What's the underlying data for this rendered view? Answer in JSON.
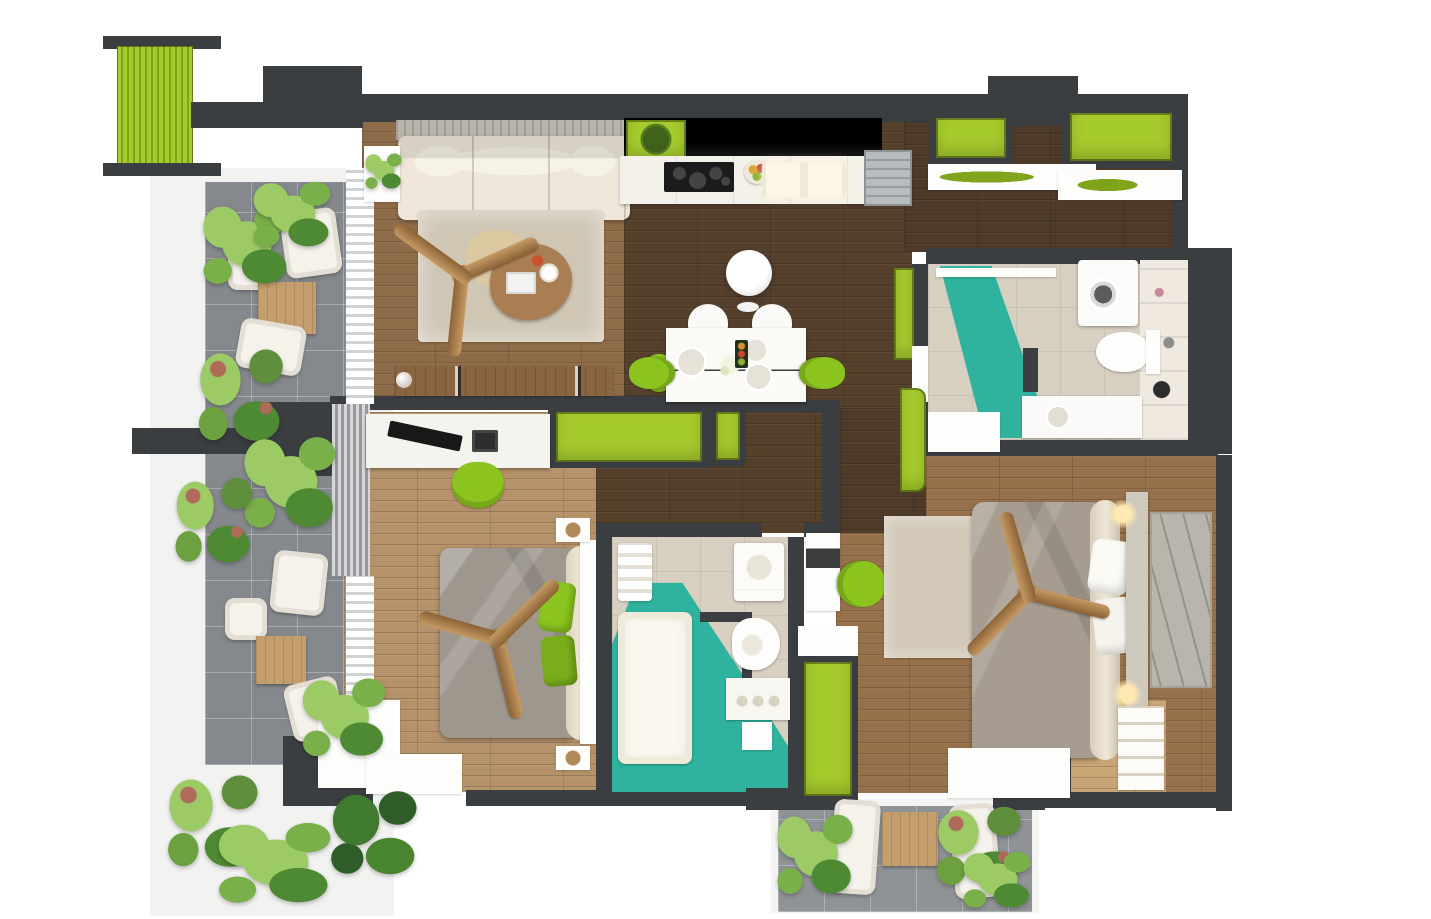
{
  "palette": {
    "wall": "#3b3e41",
    "green": "#a6cb2d",
    "greenDeep": "#7fa31a",
    "greenChair": "#8bc41e",
    "teal": "#2fb39e",
    "tealDeep": "#1f9c89",
    "woodLiving": "#8f6c49",
    "woodDark": "#55402c",
    "woodEntry": "#4e3a29",
    "woodBed1": "#b5926a",
    "woodBed2": "#96714b",
    "woodNook": "#c9a474",
    "cream": "#efe8da",
    "rug": "#cfc6b4",
    "grayTile": "#85898d",
    "bathTile": "#d7cfc0",
    "counterBlack": "#131313",
    "duvetGray": "#9e978e",
    "duvetTaupe": "#a69d90",
    "pl1": "#7ab04a",
    "pl2": "#9ccb66",
    "pl3": "#4e8a33"
  },
  "rooms": {
    "terrace": "terrace-balcony",
    "living": "living-room",
    "kitchen": "kitchen",
    "dining": "dining-area",
    "entry": "entry-hall",
    "bath1": "bathroom-top-right",
    "bath2": "bathroom-center",
    "bed1": "bedroom-left",
    "bed2": "bedroom-right",
    "balcony2": "small-balcony-bottom"
  }
}
